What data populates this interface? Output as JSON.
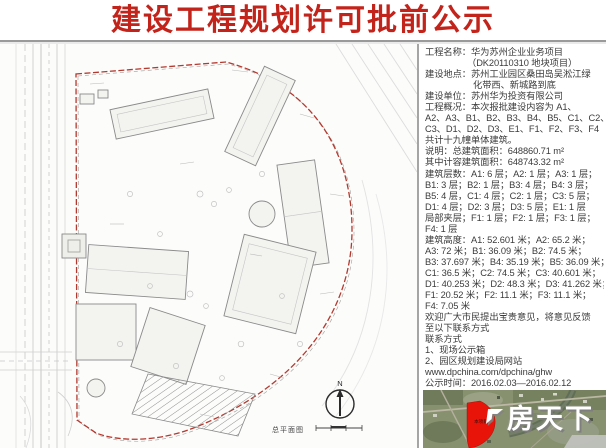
{
  "title": "建设工程规划许可批前公示",
  "colors": {
    "title_red": "#c2241b",
    "boundary_red": "#b5382e",
    "site_fill_red": "#e81309",
    "panel_text": "#3b3b3b"
  },
  "info_panel": {
    "lines": [
      {
        "t": "工程名称：华为苏州企业业务项目",
        "in": 0
      },
      {
        "t": "（DK20110310 地块项目）",
        "in": 1
      },
      {
        "t": "建设地点：苏州工业园区桑田岛吴淞江绿",
        "in": 0
      },
      {
        "t": "化带西、新城路到底",
        "in": 2
      },
      {
        "t": "建设单位：苏州华为投资有限公司",
        "in": 0
      },
      {
        "t": "工程概况：本次报批建设内容为 A1、",
        "in": 0
      },
      {
        "t": "A2、A3、B1、B2、B3、B4、B5、C1、C2、",
        "in": 0
      },
      {
        "t": "C3、D1、D2、D3、E1、F1、F2、F3、F4",
        "in": 0
      },
      {
        "t": "共计十九幢单体建筑。",
        "in": 0
      },
      {
        "t": "说明：总建筑面积：648860.71 m²",
        "in": 0
      },
      {
        "t": "其中计容建筑面积：648743.32 m²",
        "in": 0
      },
      {
        "t": "建筑层数：A1: 6 层；A2: 1 层；A3: 1 层；",
        "in": 0
      },
      {
        "t": "B1: 3 层；B2: 1 层；B3: 4 层；B4: 3 层；",
        "in": 0
      },
      {
        "t": "B5: 4 层，C1: 4 层；C2: 1 层；C3: 5 层；",
        "in": 0
      },
      {
        "t": "D1: 4 层；D2: 3 层；D3: 5 层；E1: 1 层",
        "in": 0
      },
      {
        "t": "局部夹层；F1: 1 层；F2: 1 层；F3: 1 层；",
        "in": 0
      },
      {
        "t": "F4: 1 层",
        "in": 0
      },
      {
        "t": "建筑高度：A1: 52.601 米；A2: 65.2 米；",
        "in": 0
      },
      {
        "t": "A3: 72 米；B1: 36.09 米；B2: 74.5 米；",
        "in": 0
      },
      {
        "t": "B3: 37.697 米；B4: 35.19 米；B5: 36.09 米；",
        "in": 0
      },
      {
        "t": "C1: 36.5 米；C2: 74.5 米；C3: 40.601 米；",
        "in": 0
      },
      {
        "t": "D1: 40.253 米；D2: 48.3 米；D3: 41.262 米；",
        "in": 0
      },
      {
        "t": "F1: 20.52 米；F2: 11.1 米；F3: 11.1 米；",
        "in": 0
      },
      {
        "t": "F4: 7.05 米",
        "in": 0
      },
      {
        "t": "欢迎广大市民提出宝贵意见，将意见反馈",
        "in": 0
      },
      {
        "t": "至以下联系方式",
        "in": 0
      },
      {
        "t": "联系方式",
        "in": 0
      },
      {
        "t": "1、现场公示箱",
        "in": 0
      },
      {
        "t": "2、园区规划建设局网站",
        "in": 0
      },
      {
        "t": "www.dpchina.com/dpchina/ghw",
        "in": 0
      },
      {
        "t": "公示时间：2016.02.03—2016.02.12",
        "in": 0
      }
    ]
  },
  "site_plan": {
    "label": "总平面图",
    "north_label": "N"
  },
  "satellite_map": {
    "site_label": "本项目"
  },
  "watermark": {
    "text": "房天下"
  }
}
